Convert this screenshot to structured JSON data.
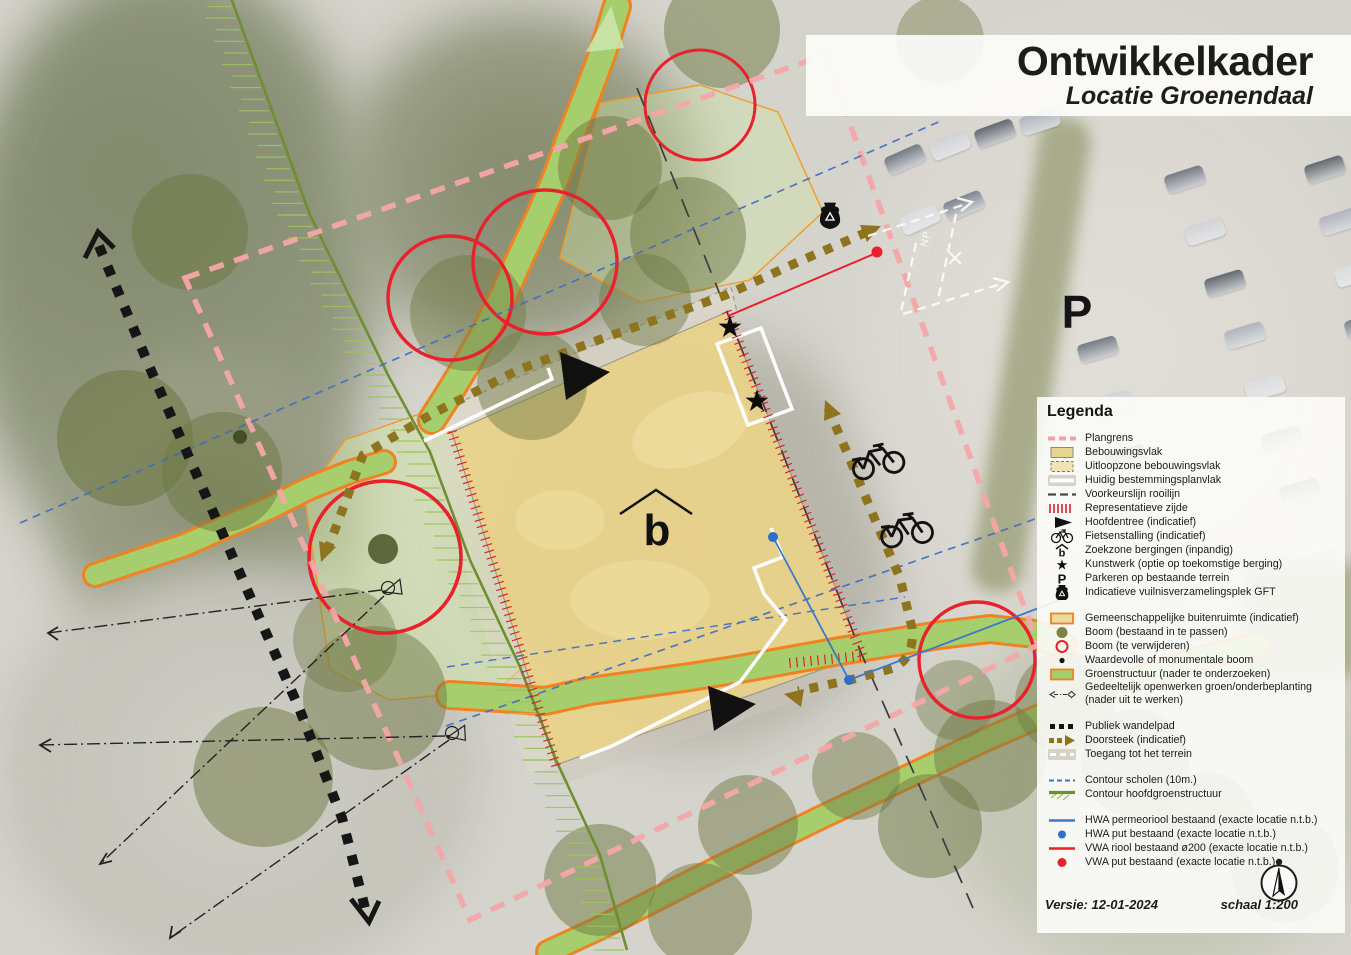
{
  "title": {
    "main": "Ontwikkelkader",
    "subtitle": "Locatie Groenendaal"
  },
  "legend": {
    "heading": "Legenda",
    "groups": [
      {
        "items": [
          {
            "key": "plangrens",
            "swatch": "dash-pink",
            "label": "Plangrens"
          },
          {
            "key": "bebouwingsvlak",
            "swatch": "rect-tan",
            "label": "Bebouwingsvlak"
          },
          {
            "key": "uitloopzone-bebouwingsvlak",
            "swatch": "rect-tan-dash",
            "label": "Uitloopzone bebouwingsvlak"
          },
          {
            "key": "huidig-bestemmingsplanvlak",
            "swatch": "line-white",
            "label": "Huidig bestemmingsplanvlak"
          },
          {
            "key": "voorkeurslijn-rooilijn",
            "swatch": "dash-dark",
            "label": "Voorkeurslijn rooilijn"
          },
          {
            "key": "representatieve-zijde",
            "swatch": "ticks-red",
            "label": "Representatieve zijde"
          },
          {
            "key": "hoofdentree",
            "swatch": "tri-black",
            "label": "Hoofdentree (indicatief)"
          },
          {
            "key": "fietsenstalling",
            "swatch": "bike",
            "label": "Fietsenstalling (indicatief)"
          },
          {
            "key": "zoekzone-bergingen",
            "swatch": "zoekzone",
            "label": "Zoekzone bergingen (inpandig)"
          },
          {
            "key": "kunstwerk",
            "swatch": "star",
            "label": "Kunstwerk (optie op toekomstige berging)"
          },
          {
            "key": "parkeren",
            "swatch": "letter-p",
            "label": "Parkeren op bestaande terrein"
          },
          {
            "key": "gft",
            "swatch": "gft",
            "label": "Indicatieve vuilnisverzamelingsplek GFT"
          }
        ]
      },
      {
        "items": [
          {
            "key": "gemeenschappelijke-buitenruimte",
            "swatch": "rect-orange",
            "label": "Gemeenschappelijke buitenruimte (indicatief)"
          },
          {
            "key": "boom-bestaand",
            "swatch": "circle-olive",
            "label": "Boom (bestaand in te passen)"
          },
          {
            "key": "boom-te-verwijderen",
            "swatch": "circle-red",
            "label": "Boom (te verwijderen)"
          },
          {
            "key": "waardevolle-boom",
            "swatch": "dot-black",
            "label": "Waardevolle of monumentale boom"
          },
          {
            "key": "groenstructuur",
            "swatch": "rect-green",
            "label": "Groenstructuur (nader te onderzoeken)"
          },
          {
            "key": "gedeeltelijk-openwerken",
            "swatch": "openwerk",
            "label": "Gedeeltelijk openwerken groen/onderbeplanting",
            "label2": "(nader uit te werken)"
          }
        ]
      },
      {
        "items": [
          {
            "key": "publiek-wandelpad",
            "swatch": "dots-black",
            "label": "Publiek wandelpad"
          },
          {
            "key": "doorsteek",
            "swatch": "dots-brown",
            "label": "Doorsteek (indicatief)"
          },
          {
            "key": "toegang-terrein",
            "swatch": "dash-white",
            "label": "Toegang tot het terrein"
          }
        ]
      },
      {
        "items": [
          {
            "key": "contour-scholen",
            "swatch": "dash-blue",
            "label": "Contour scholen (10m.)"
          },
          {
            "key": "contour-hoofdgroenstructuur",
            "swatch": "line-greenhatch",
            "label": "Contour hoofdgroenstructuur"
          }
        ]
      },
      {
        "items": [
          {
            "key": "hwa-permeoriool",
            "swatch": "line-blue",
            "label": "HWA permeoriool bestaand (exacte locatie n.t.b.)"
          },
          {
            "key": "hwa-put",
            "swatch": "dot-blue",
            "label": "HWA put bestaand (exacte locatie n.t.b.)"
          },
          {
            "key": "vwa-riool",
            "swatch": "line-red",
            "label": "VWA riool bestaand ø200 (exacte locatie n.t.b.)"
          },
          {
            "key": "vwa-put",
            "swatch": "dot-red",
            "label": "VWA put bestaand (exacte locatie n.t.b.)"
          }
        ]
      }
    ]
  },
  "footer": {
    "version": "Versie: 12-01-2024",
    "scale": "schaal 1:200"
  },
  "map_labels": {
    "parking": "P",
    "building": "b",
    "photo_marking": "NP"
  },
  "colors": {
    "plangrens": "#f2a2a4",
    "bebouwingsvlak": "#e9d68e",
    "groen": "#a6ce6d",
    "oranje": "#f08222",
    "rood": "#e8212d",
    "blauw": "#3f6cc0",
    "bruin": "#8d741d",
    "contour_groen": "#6d8f2f"
  }
}
